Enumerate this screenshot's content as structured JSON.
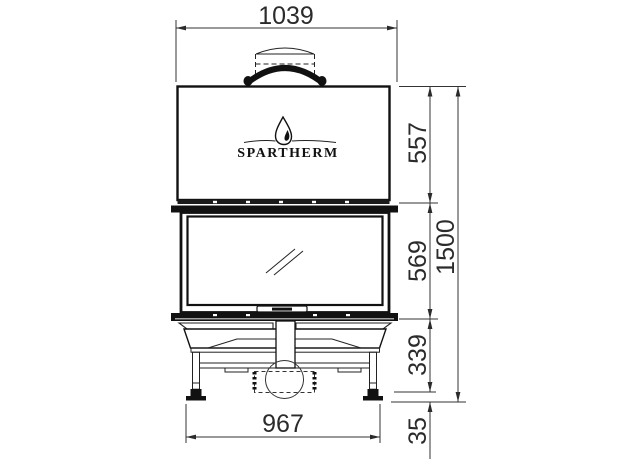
{
  "drawing": {
    "brand": "SPARTHERM",
    "view": "fireplace-front-elevation",
    "colors": {
      "line": "#2b2b2b",
      "dark": "#111111",
      "background": "#ffffff"
    },
    "dimensions": {
      "top_width": "1039",
      "bottom_width": "967",
      "total_height": "1500",
      "upper_section_height": "557",
      "door_section_height": "569",
      "base_section_height": "339",
      "foot_height": "35"
    }
  }
}
